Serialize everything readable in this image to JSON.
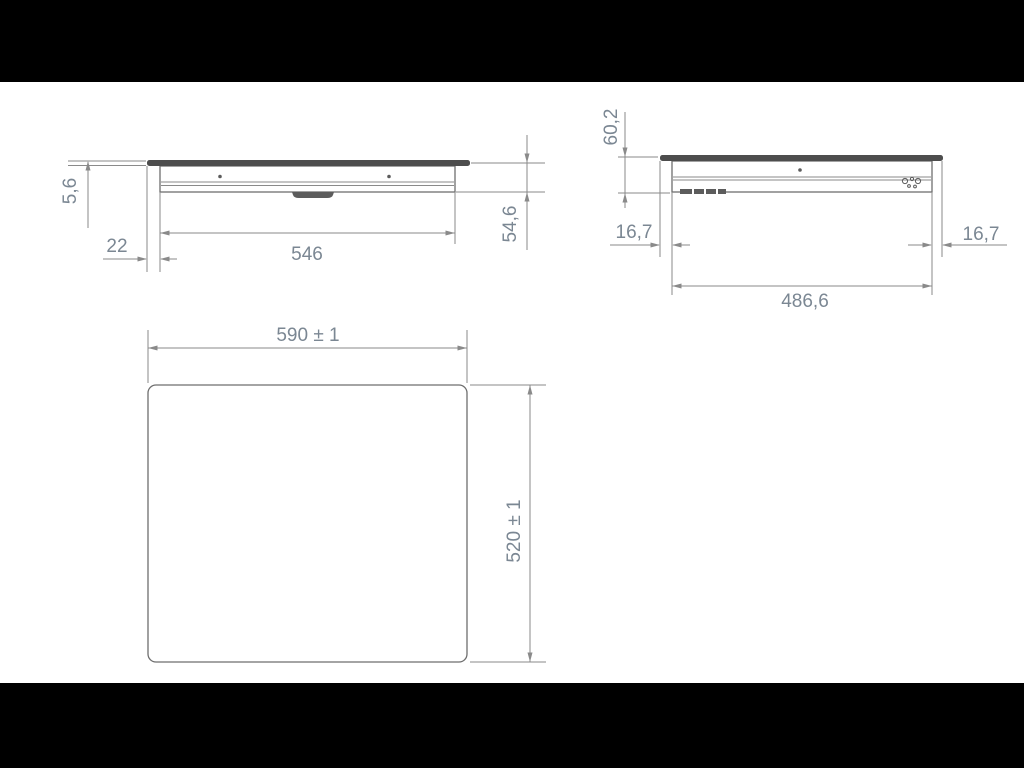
{
  "drawing_type": "appliance-installation-dimension-drawing",
  "colors": {
    "background": "#000000",
    "paper": "#ffffff",
    "line": "#8a8a8a",
    "outline": "#6e6e6e",
    "glass": "#4d4d4d",
    "dimension_text": "#7b8793"
  },
  "front_view": {
    "glass_thickness": "5,6",
    "glass_overhang": "22",
    "body_width": "546",
    "body_height": "54,6"
  },
  "side_view": {
    "total_height": "60,2",
    "overhang_left": "16,7",
    "overhang_right": "16,7",
    "body_depth": "486,6"
  },
  "plan_view": {
    "outer_width": "590 ± 1",
    "outer_depth": "520 ± 1"
  }
}
